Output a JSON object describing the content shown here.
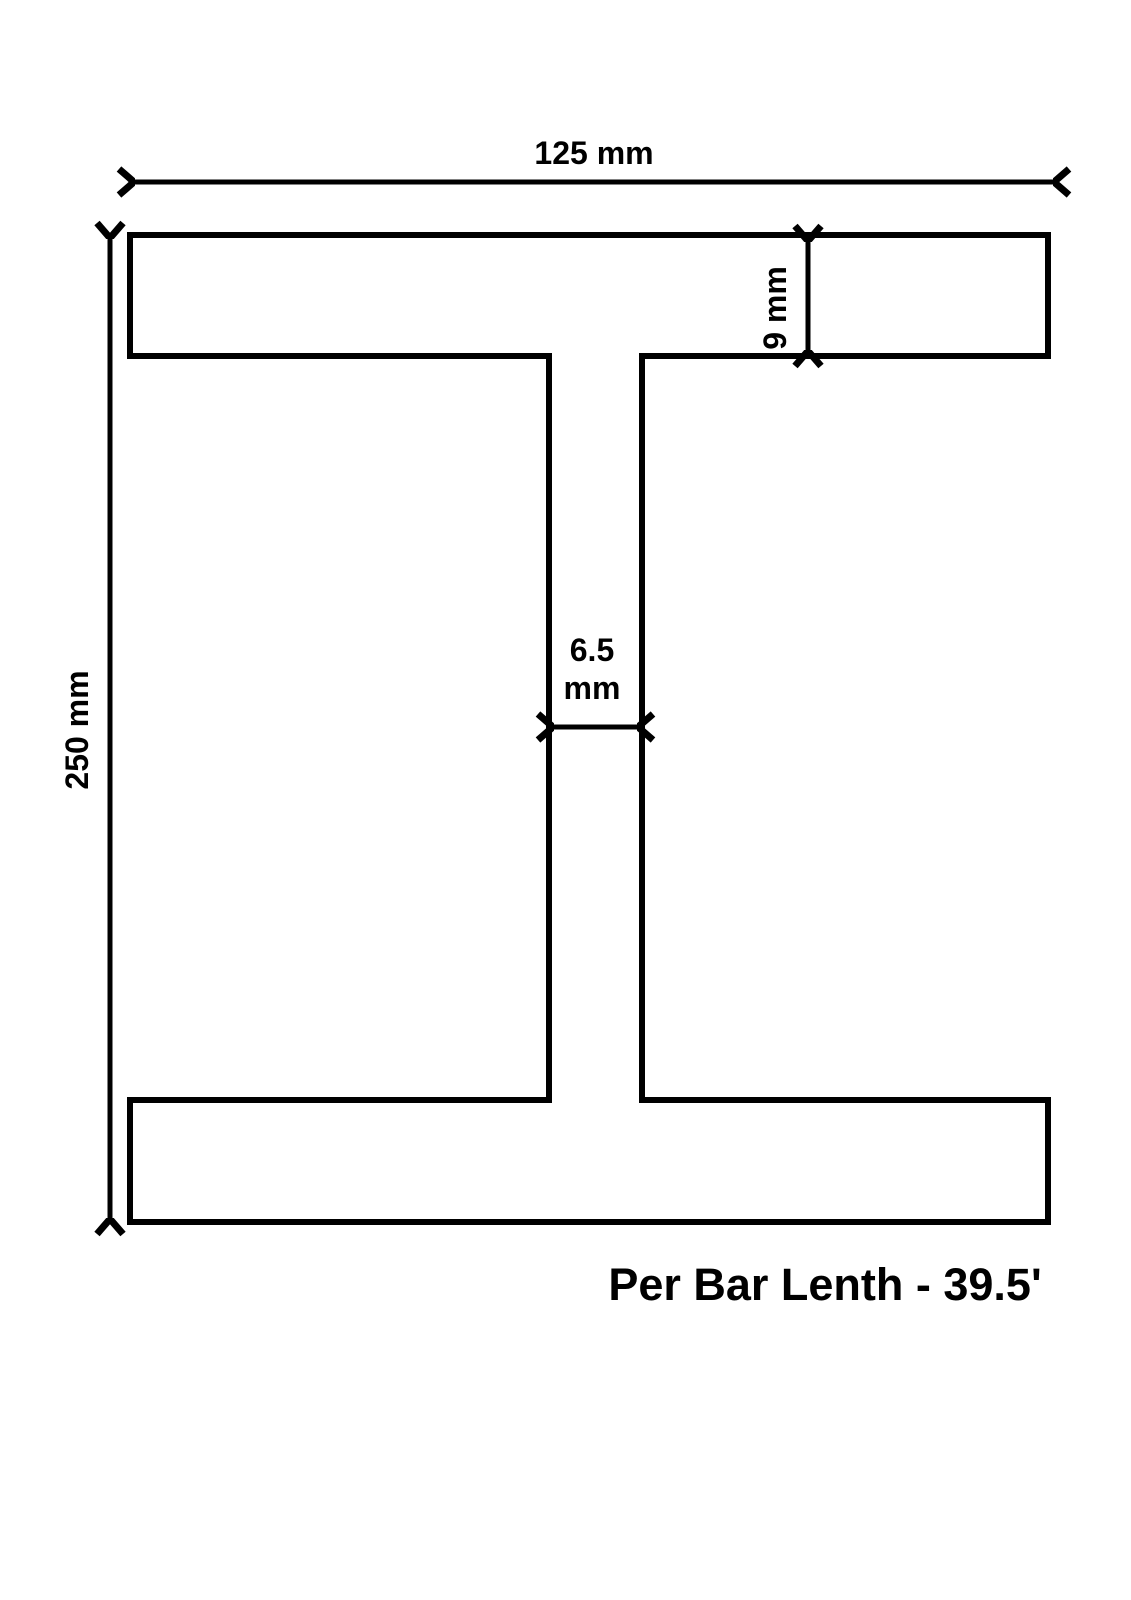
{
  "page": {
    "background_color": "#ffffff",
    "line_color": "#000000"
  },
  "diagram": {
    "subject": "i-beam-cross-section",
    "title": "Per Bar Lenth - 39.5'",
    "labels": {
      "overall_width": "125 mm",
      "overall_height": "250 mm",
      "flange_thickness": "9 mm",
      "web_thickness_value": "6.5",
      "web_thickness_unit": "mm"
    },
    "measurements": {
      "overall_width_mm": 125,
      "overall_height_mm": 250,
      "flange_thickness_mm": 9,
      "web_thickness_mm": 6.5,
      "per_bar_length_ft": 39.5
    }
  }
}
